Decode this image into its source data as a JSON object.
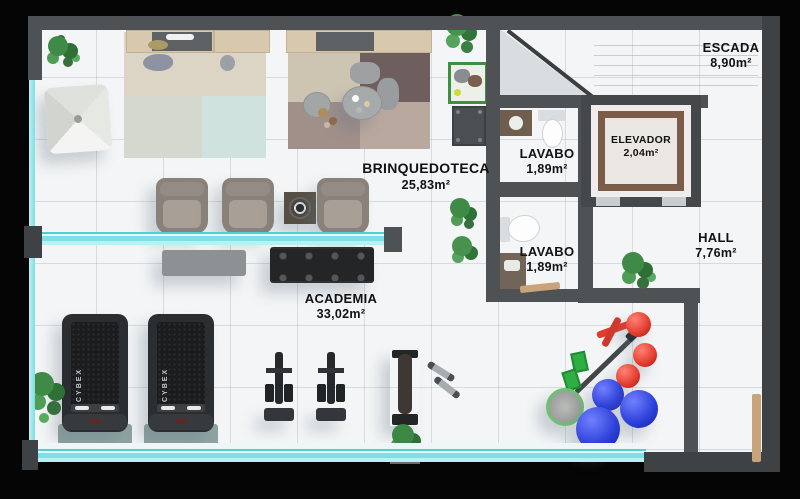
{
  "plan": {
    "rooms": {
      "brinquedoteca": {
        "name": "BRINQUEDOTECA",
        "area": "25,83m²"
      },
      "academia": {
        "name": "ACADEMIA",
        "area": "33,02m²"
      },
      "lavabo_superior": {
        "name": "LAVABO",
        "area": "1,89m²"
      },
      "lavabo_inferior": {
        "name": "LAVABO",
        "area": "1,89m²"
      },
      "elevador": {
        "name": "ELEVADOR",
        "area": "2,04m²"
      },
      "escada": {
        "name": "ESCADA",
        "area": "8,90m²"
      },
      "hall": {
        "name": "HALL",
        "area": "7,76m²"
      }
    },
    "equipment": {
      "treadmill_brand": "CYBEX"
    },
    "colors": {
      "background": "#000000",
      "floor": "#f3f5f6",
      "wall": "#4e5254",
      "glass": "#7edfe4",
      "ball_red": "#e23b2c",
      "ball_blue": "#2b3fd8",
      "plant_green": "#3f8a46",
      "wood_shelf": "#d8c9ae"
    }
  }
}
